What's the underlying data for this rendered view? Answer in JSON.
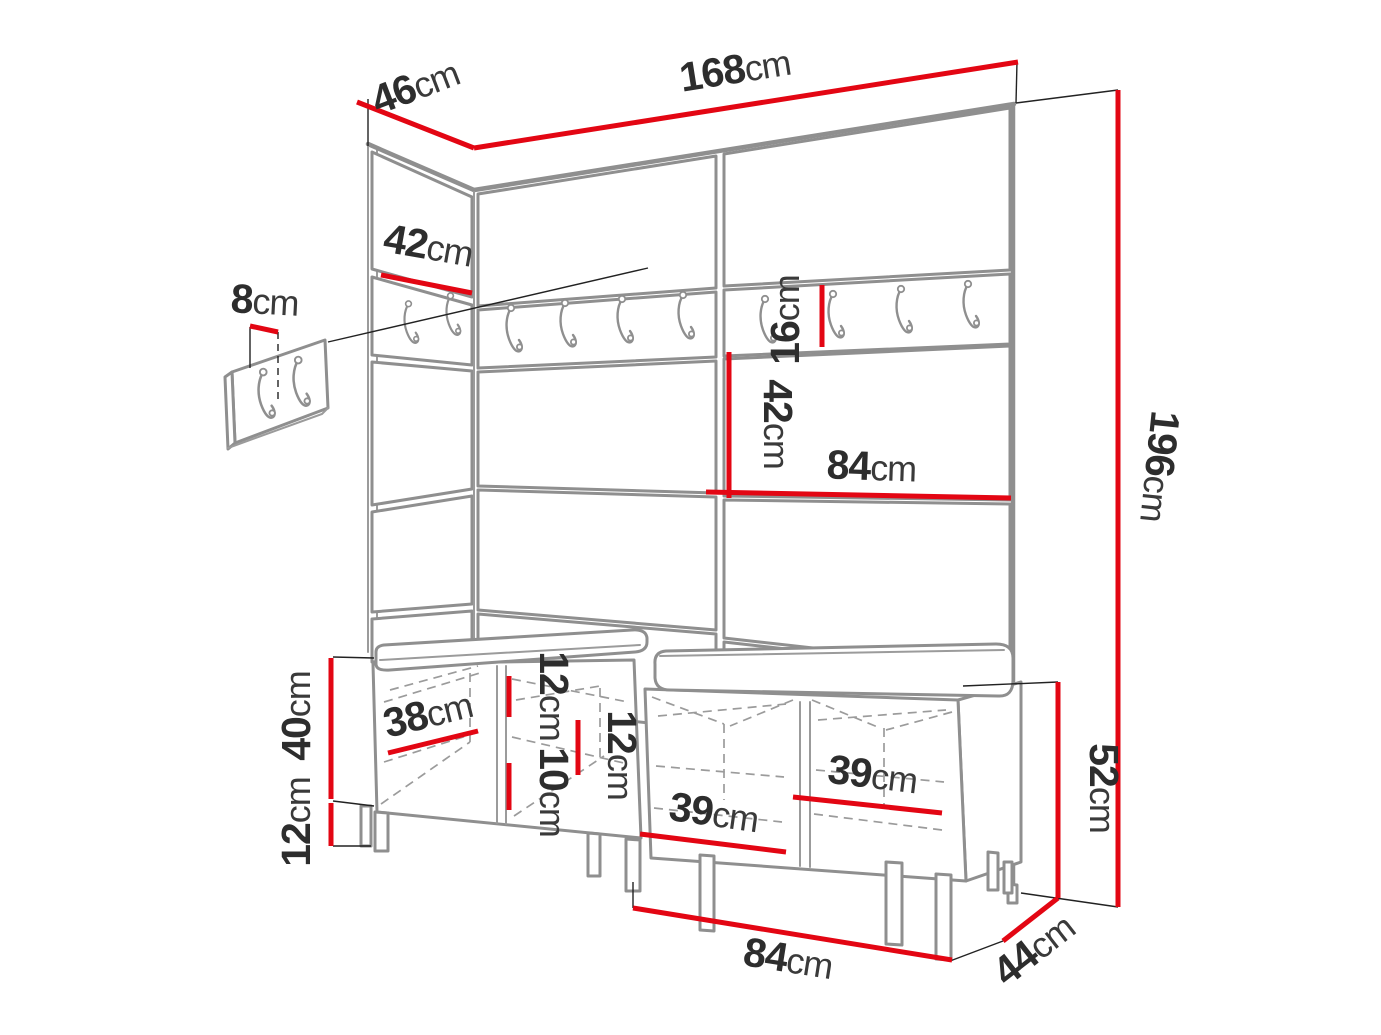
{
  "diagram": {
    "type": "furniture-dimension-drawing",
    "subject": "hallway wardrobe set: wall panels with coat hooks, small wall hook panel and two shoe benches with cushions",
    "colors": {
      "dimension_line": "#e30613",
      "structure_line": "#8f8f8f",
      "extension_line": "#222222",
      "text": "#2d2d2d",
      "background": "#ffffff"
    },
    "dimensions": [
      {
        "id": "top-side-depth",
        "value": "46",
        "unit": "cm"
      },
      {
        "id": "total-width",
        "value": "168",
        "unit": "cm"
      },
      {
        "id": "side-panel-width",
        "value": "42",
        "unit": "cm"
      },
      {
        "id": "wall-panel-depth",
        "value": "8",
        "unit": "cm"
      },
      {
        "id": "hook-rail-height",
        "value": "16",
        "unit": "cm"
      },
      {
        "id": "middle-panel-height",
        "value": "42",
        "unit": "cm"
      },
      {
        "id": "middle-panel-width",
        "value": "84",
        "unit": "cm"
      },
      {
        "id": "total-height",
        "value": "196",
        "unit": "cm"
      },
      {
        "id": "bench-body-height",
        "value": "40",
        "unit": "cm"
      },
      {
        "id": "bench-leg-height",
        "value": "12",
        "unit": "cm"
      },
      {
        "id": "seat-top-offset",
        "value": "12",
        "unit": "cm"
      },
      {
        "id": "shelf-spacing",
        "value": "10",
        "unit": "cm"
      },
      {
        "id": "right-compartment-offset",
        "value": "12",
        "unit": "cm"
      },
      {
        "id": "left-compartment-width",
        "value": "38",
        "unit": "cm"
      },
      {
        "id": "bench2-left-compartment",
        "value": "39",
        "unit": "cm"
      },
      {
        "id": "bench2-right-compartment",
        "value": "39",
        "unit": "cm"
      },
      {
        "id": "bench-total-height",
        "value": "52",
        "unit": "cm"
      },
      {
        "id": "bench-depth",
        "value": "44",
        "unit": "cm"
      },
      {
        "id": "bench-width",
        "value": "84",
        "unit": "cm"
      }
    ]
  }
}
